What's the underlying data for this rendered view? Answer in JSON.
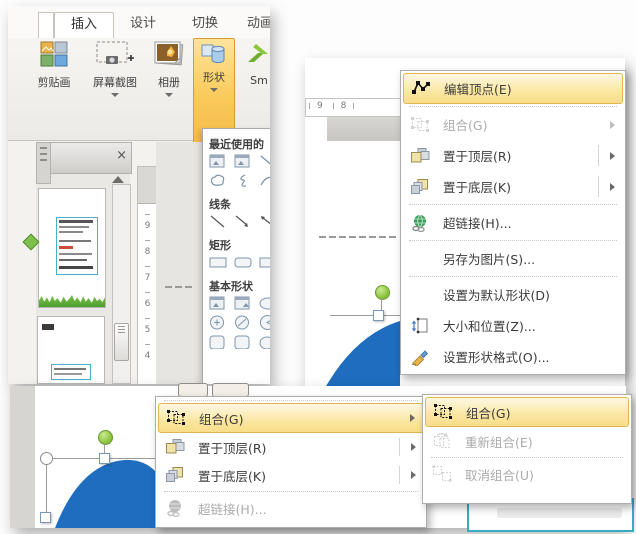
{
  "ribbon": {
    "tabs": [
      {
        "label": "插入",
        "active": true
      },
      {
        "label": "设计",
        "active": false
      },
      {
        "label": "切换",
        "active": false
      },
      {
        "label": "动画",
        "active": false
      }
    ],
    "buttons": {
      "clipart": {
        "label": "剪贴画"
      },
      "screenshot": {
        "label": "屏幕截图"
      },
      "photo_album": {
        "label": "相册"
      },
      "shapes": {
        "label": "形状",
        "highlighted": true
      },
      "smartart": {
        "label": "Sm"
      }
    },
    "group_label": "图像"
  },
  "shapes_panel": {
    "sections": {
      "recent": "最近使用的",
      "lines": "线条",
      "rectangles": "矩形",
      "basic": "基本形状"
    }
  },
  "rulers": {
    "vertical_numbers": [
      "9",
      "8",
      "7",
      "6",
      "5",
      "4"
    ],
    "horizontal_numbers": [
      "9",
      "8"
    ]
  },
  "context_menu": {
    "items": [
      {
        "label": "编辑顶点(E)",
        "icon": "edit-points-icon",
        "state": "highlighted"
      },
      {
        "label": "组合(G)",
        "icon": "group-icon",
        "state": "disabled",
        "has_submenu": true
      },
      {
        "label": "置于顶层(R)",
        "icon": "bring-to-front-icon",
        "state": "normal",
        "has_submenu": true
      },
      {
        "label": "置于底层(K)",
        "icon": "send-to-back-icon",
        "state": "normal",
        "has_submenu": true
      },
      {
        "label": "超链接(H)...",
        "icon": "hyperlink-icon",
        "state": "normal"
      },
      {
        "label": "另存为图片(S)...",
        "state": "normal"
      },
      {
        "label": "设置为默认形状(D)",
        "state": "normal"
      },
      {
        "label": "大小和位置(Z)...",
        "icon": "size-position-icon",
        "state": "normal"
      },
      {
        "label": "设置形状格式(O)...",
        "icon": "format-shape-icon",
        "state": "normal"
      }
    ]
  },
  "group_menu": {
    "items": [
      {
        "label": "组合(G)",
        "icon": "group-icon",
        "state": "highlighted",
        "has_submenu": true
      },
      {
        "label": "置于顶层(R)",
        "icon": "bring-to-front-icon",
        "state": "normal",
        "has_submenu": true
      },
      {
        "label": "置于底层(K)",
        "icon": "send-to-back-icon",
        "state": "normal",
        "has_submenu": true
      },
      {
        "label": "超链接(H)...",
        "icon": "hyperlink-icon",
        "state": "disabled"
      }
    ],
    "submenu": [
      {
        "label": "组合(G)",
        "icon": "group-icon",
        "state": "highlighted"
      },
      {
        "label": "重新组合(E)",
        "icon": "regroup-icon",
        "state": "disabled"
      },
      {
        "label": "取消组合(U)",
        "icon": "ungroup-icon",
        "state": "disabled"
      }
    ]
  },
  "colors": {
    "menu_highlight": "#FBE7A1",
    "menu_highlight_border": "#E2B64E",
    "shapes_button_highlight": "#F9C959",
    "shape_fill_blue": "#1E6DBE",
    "rotation_handle_green": "#8DC63F",
    "selection_box_teal": "#3BAAC0",
    "grass_green": "#63B13C"
  }
}
